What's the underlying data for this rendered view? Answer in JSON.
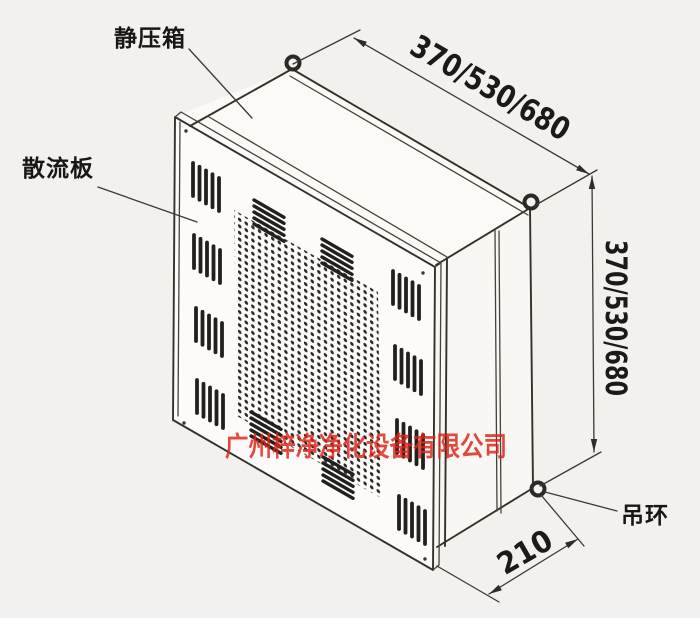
{
  "labels": {
    "plenum": "静压箱",
    "diffuser_plate": "散流板",
    "lifting_ring": "吊环"
  },
  "dimensions": {
    "top_width": "370/530/680",
    "side_height": "370/530/680",
    "depth": "210"
  },
  "watermark": {
    "text": "广州梓净净化设备有限公司",
    "color": "#dd2418"
  },
  "drawing": {
    "line_color": "#34312d",
    "background_color": "#f2f1ee",
    "parts": [
      "plenum-box",
      "diffuser-plate",
      "perforated-panel",
      "louver-vents",
      "lifting-rings"
    ]
  }
}
